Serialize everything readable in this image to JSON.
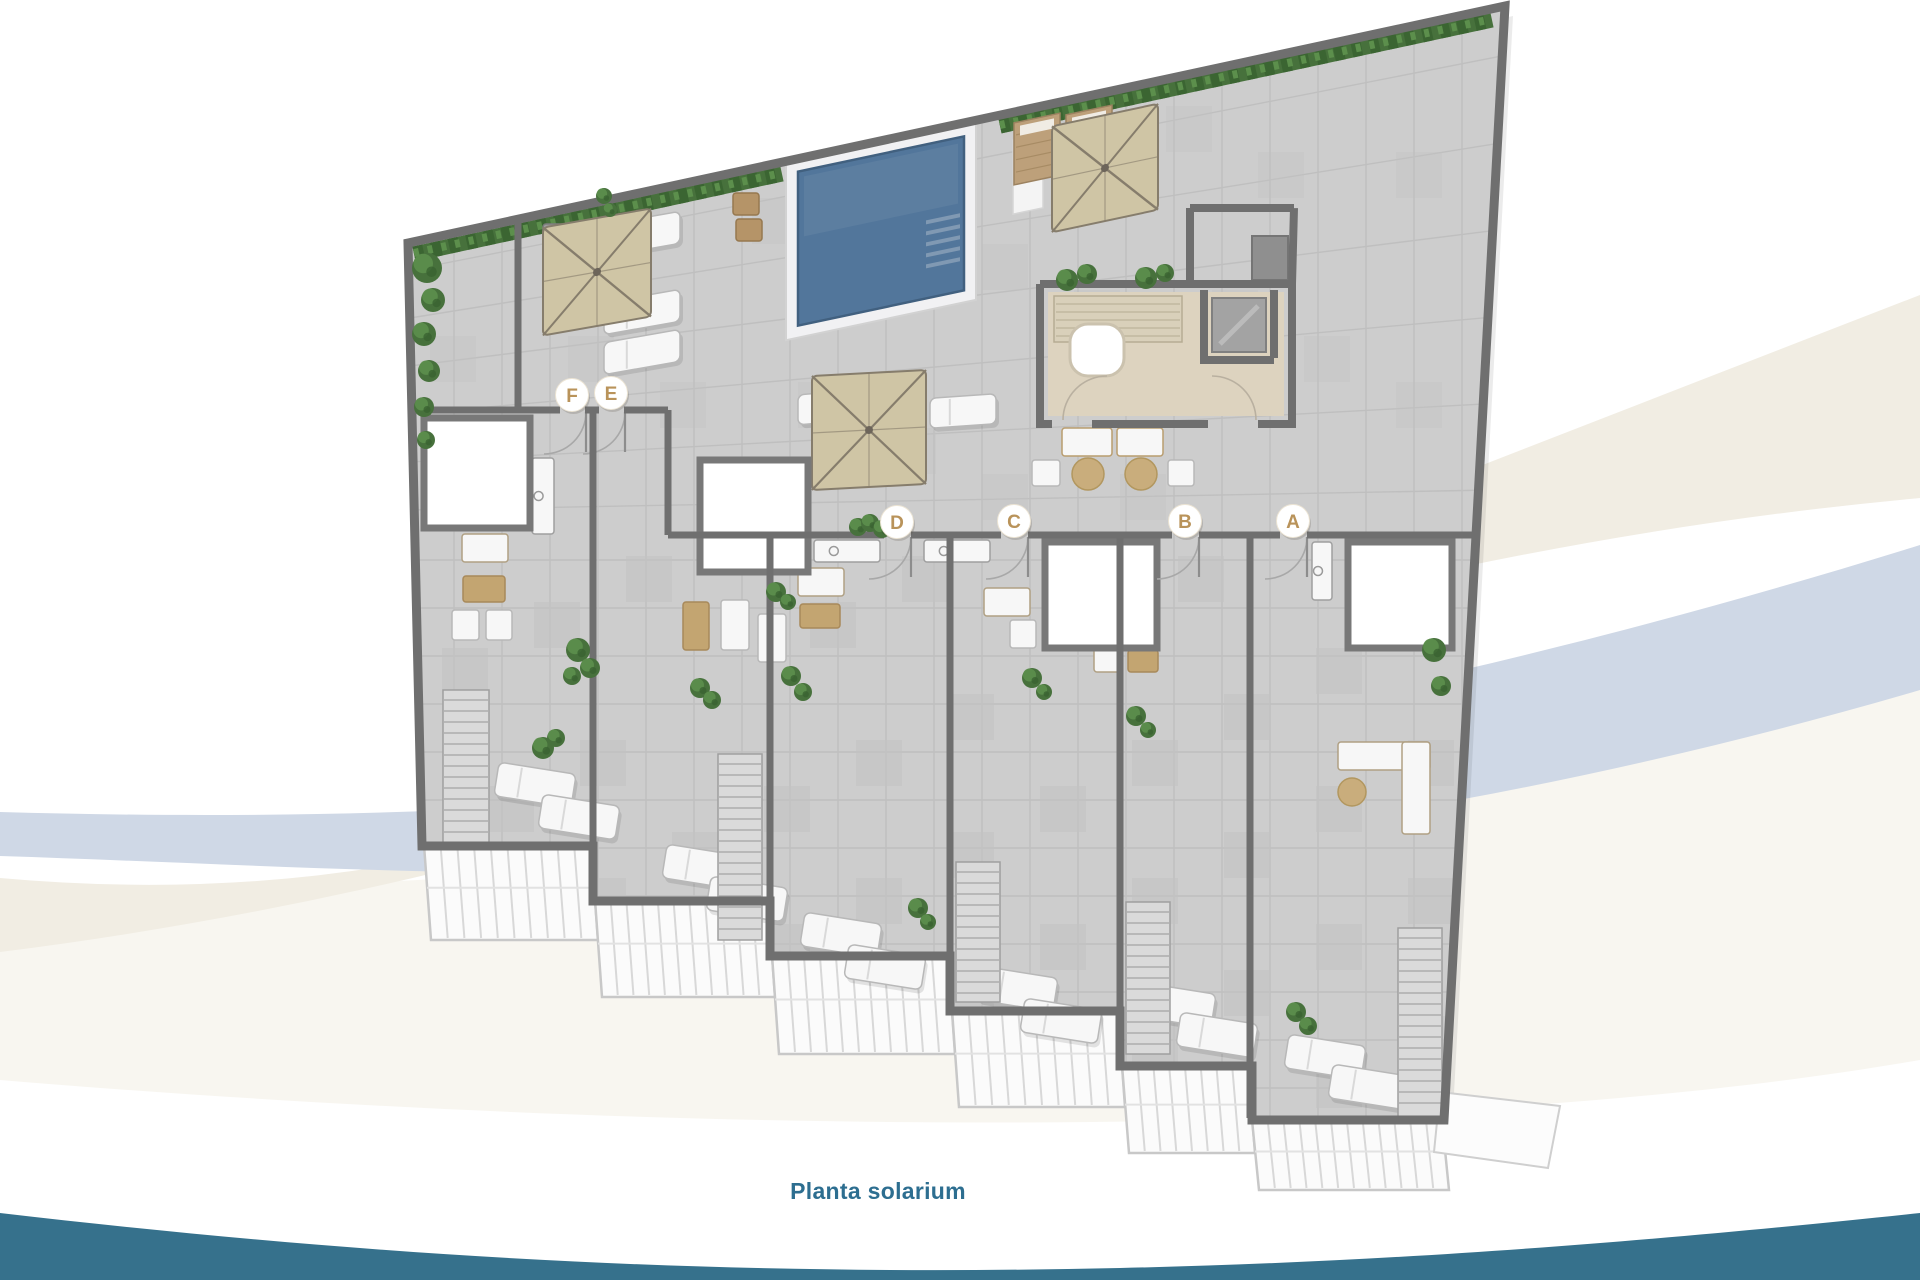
{
  "title": "Planta solarium",
  "units": [
    {
      "label": "F",
      "x": 572,
      "y": 395
    },
    {
      "label": "E",
      "x": 611,
      "y": 393
    },
    {
      "label": "D",
      "x": 897,
      "y": 522
    },
    {
      "label": "C",
      "x": 1014,
      "y": 521
    },
    {
      "label": "B",
      "x": 1185,
      "y": 521
    },
    {
      "label": "A",
      "x": 1293,
      "y": 521
    }
  ],
  "colors": {
    "title_teal": "#2d6e90",
    "wave_teal": "#36718c",
    "letter_gold": "#b9935a",
    "pool_water": "#52769b",
    "pool_edge": "#41607f",
    "hedge_green": "#47713c",
    "hedge_dark": "#396331",
    "hedge_light": "#5c8f4c",
    "umbrella_tan": "#cfc5a5",
    "umbrella_frame": "#867d6c",
    "floor_tile": "#cdcdcd",
    "tile_line": "#bfbfbf",
    "wall_gray": "#6f6f6f",
    "core_floor": "#ddd3bf",
    "wood_tan": "#bda07a",
    "furniture_white": "#f7f7f7",
    "ribbon_cream": "#f1ede3",
    "ribbon_blue": "#cfd8e6",
    "ribbon_wash": "#f5f2ea"
  }
}
